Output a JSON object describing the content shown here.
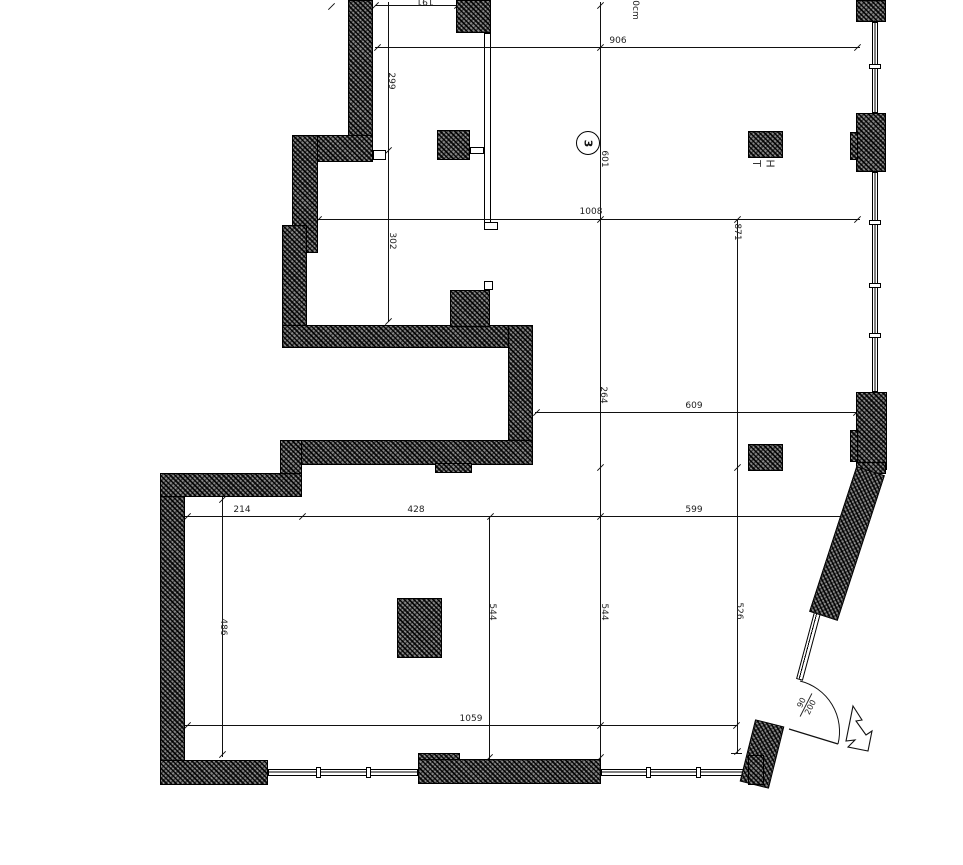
{
  "drawing_title": "floor-plan-sheet",
  "dims": {
    "n191": "191",
    "n299": "299",
    "n302": "302",
    "n906": "906",
    "topnote": "0cm",
    "n601": "601",
    "n1008": "1008",
    "n871": "871",
    "n264": "264",
    "n609": "609",
    "n214": "214",
    "n428": "428",
    "n599": "599",
    "n544a": "544",
    "n544b": "544",
    "n526": "526",
    "n486": "486",
    "n1059": "1059"
  },
  "marker": {
    "number": "3"
  },
  "column_label": {
    "first": "T",
    "second": "H"
  },
  "door_tag": {
    "width": "90",
    "height": "200"
  },
  "colors": {
    "line": "#111111",
    "wall_fill": "#6b6b6b",
    "background": "#ffffff"
  }
}
